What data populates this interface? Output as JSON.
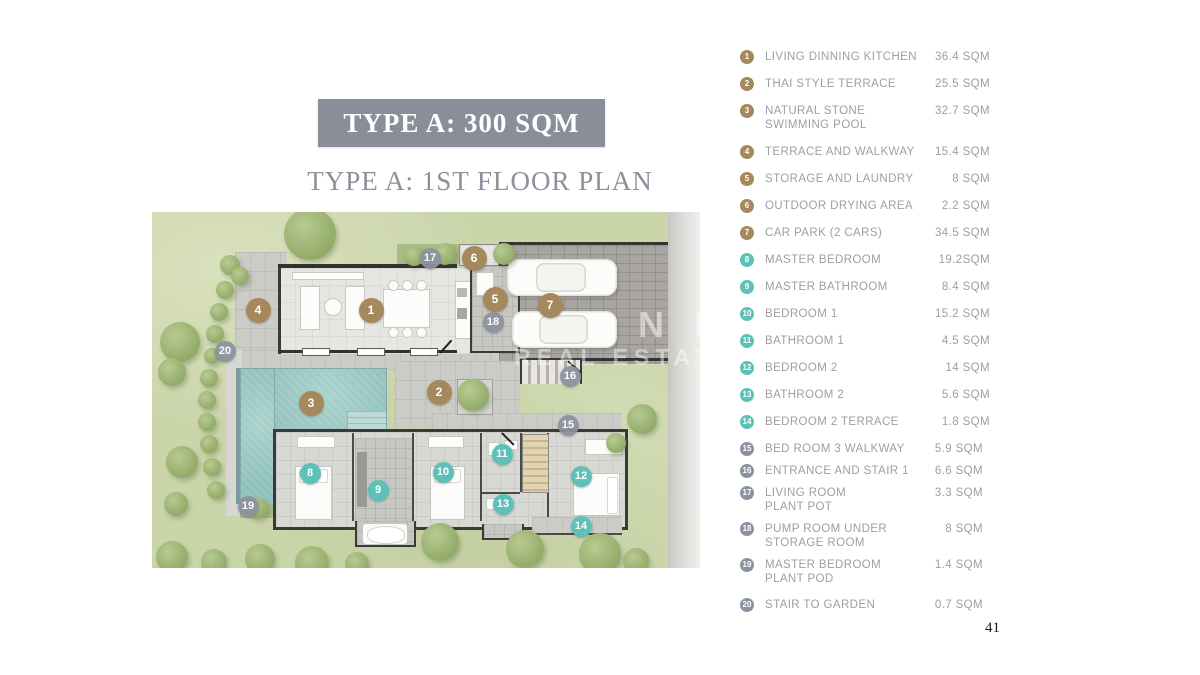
{
  "header": {
    "title": "TYPE A: 300 SQM",
    "subtitle": "TYPE A: 1ST FLOOR PLAN"
  },
  "page_number": "41",
  "watermark": {
    "line1": "N PH",
    "line2": "REAL ESTATE"
  },
  "colors": {
    "brown": "#a5895c",
    "teal": "#5ec1b8",
    "gray": "#8b93a0",
    "title_box": "#8a8e99",
    "legend_text": "#9aa0a6",
    "pool": "#9ac7c3"
  },
  "legend": {
    "items": [
      {
        "num": "1",
        "label": "LIVING DINNING KITCHEN",
        "value": "36.4 SQM",
        "color": "brown"
      },
      {
        "num": "2",
        "label": "THAI STYLE TERRACE",
        "value": "25.5 SQM",
        "color": "brown"
      },
      {
        "num": "3",
        "label": "NATURAL STONE\nSWIMMING POOL",
        "value": "32.7 SQM",
        "color": "brown"
      },
      {
        "num": "4",
        "label": "TERRACE AND WALKWAY",
        "value": "15.4 SQM",
        "color": "brown"
      },
      {
        "num": "5",
        "label": "STORAGE AND LAUNDRY",
        "value": "8 SQM",
        "color": "brown"
      },
      {
        "num": "6",
        "label": "OUTDOOR DRYING AREA",
        "value": "2.2 SQM",
        "color": "brown"
      },
      {
        "num": "7",
        "label": "CAR PARK (2 CARS)",
        "value": "34.5 SQM",
        "color": "brown"
      },
      {
        "num": "8",
        "label": "MASTER BEDROOM",
        "value": "19.2SQM",
        "color": "teal"
      },
      {
        "num": "9",
        "label": "MASTER BATHROOM",
        "value": "8.4 SQM",
        "color": "teal"
      },
      {
        "num": "10",
        "label": "BEDROOM 1",
        "value": "15.2 SQM",
        "color": "teal"
      },
      {
        "num": "11",
        "label": "BATHROOM 1",
        "value": "4.5 SQM",
        "color": "teal"
      },
      {
        "num": "12",
        "label": "BEDROOM 2",
        "value": "14 SQM",
        "color": "teal"
      },
      {
        "num": "13",
        "label": "BATHROOM 2",
        "value": "5.6 SQM",
        "color": "teal"
      },
      {
        "num": "14",
        "label": "BEDROOM 2 TERRACE",
        "value": "1.8 SQM",
        "color": "teal"
      },
      {
        "num": "15",
        "label": "BED ROOM 3 WALKWAY",
        "value": "5.9 SQM",
        "color": "gray"
      },
      {
        "num": "16",
        "label": "ENTRANCE AND STAIR 1",
        "value": "6.6 SQM",
        "color": "gray"
      },
      {
        "num": "17",
        "label": "LIVING ROOM\nPLANT POT",
        "value": "3.3 SQM",
        "color": "gray"
      },
      {
        "num": "18",
        "label": "PUMP ROOM UNDER\nSTORAGE ROOM",
        "value": "8 SQM",
        "color": "gray"
      },
      {
        "num": "19",
        "label": "MASTER BEDROOM\nPLANT POD",
        "value": "1.4 SQM",
        "color": "gray"
      },
      {
        "num": "20",
        "label": "STAIR TO GARDEN",
        "value": "0.7 SQM",
        "color": "gray"
      }
    ]
  },
  "plan_markers": [
    {
      "num": "1",
      "x": 219,
      "y": 98,
      "color": "brown"
    },
    {
      "num": "2",
      "x": 287,
      "y": 180,
      "color": "brown"
    },
    {
      "num": "3",
      "x": 159,
      "y": 191,
      "color": "brown"
    },
    {
      "num": "4",
      "x": 106,
      "y": 98,
      "color": "brown"
    },
    {
      "num": "5",
      "x": 343,
      "y": 87,
      "color": "brown"
    },
    {
      "num": "6",
      "x": 322,
      "y": 46,
      "color": "brown"
    },
    {
      "num": "7",
      "x": 398,
      "y": 93,
      "color": "brown"
    },
    {
      "num": "8",
      "x": 158,
      "y": 261,
      "color": "teal"
    },
    {
      "num": "9",
      "x": 226,
      "y": 278,
      "color": "teal"
    },
    {
      "num": "10",
      "x": 291,
      "y": 260,
      "color": "teal"
    },
    {
      "num": "11",
      "x": 350,
      "y": 242,
      "color": "teal"
    },
    {
      "num": "12",
      "x": 429,
      "y": 264,
      "color": "teal"
    },
    {
      "num": "13",
      "x": 351,
      "y": 292,
      "color": "teal"
    },
    {
      "num": "14",
      "x": 429,
      "y": 314,
      "color": "teal"
    },
    {
      "num": "15",
      "x": 416,
      "y": 213,
      "color": "gray"
    },
    {
      "num": "16",
      "x": 418,
      "y": 164,
      "color": "gray"
    },
    {
      "num": "17",
      "x": 278,
      "y": 46,
      "color": "gray"
    },
    {
      "num": "18",
      "x": 341,
      "y": 110,
      "color": "gray"
    },
    {
      "num": "19",
      "x": 96,
      "y": 294,
      "color": "gray"
    },
    {
      "num": "20",
      "x": 73,
      "y": 139,
      "color": "gray"
    }
  ]
}
